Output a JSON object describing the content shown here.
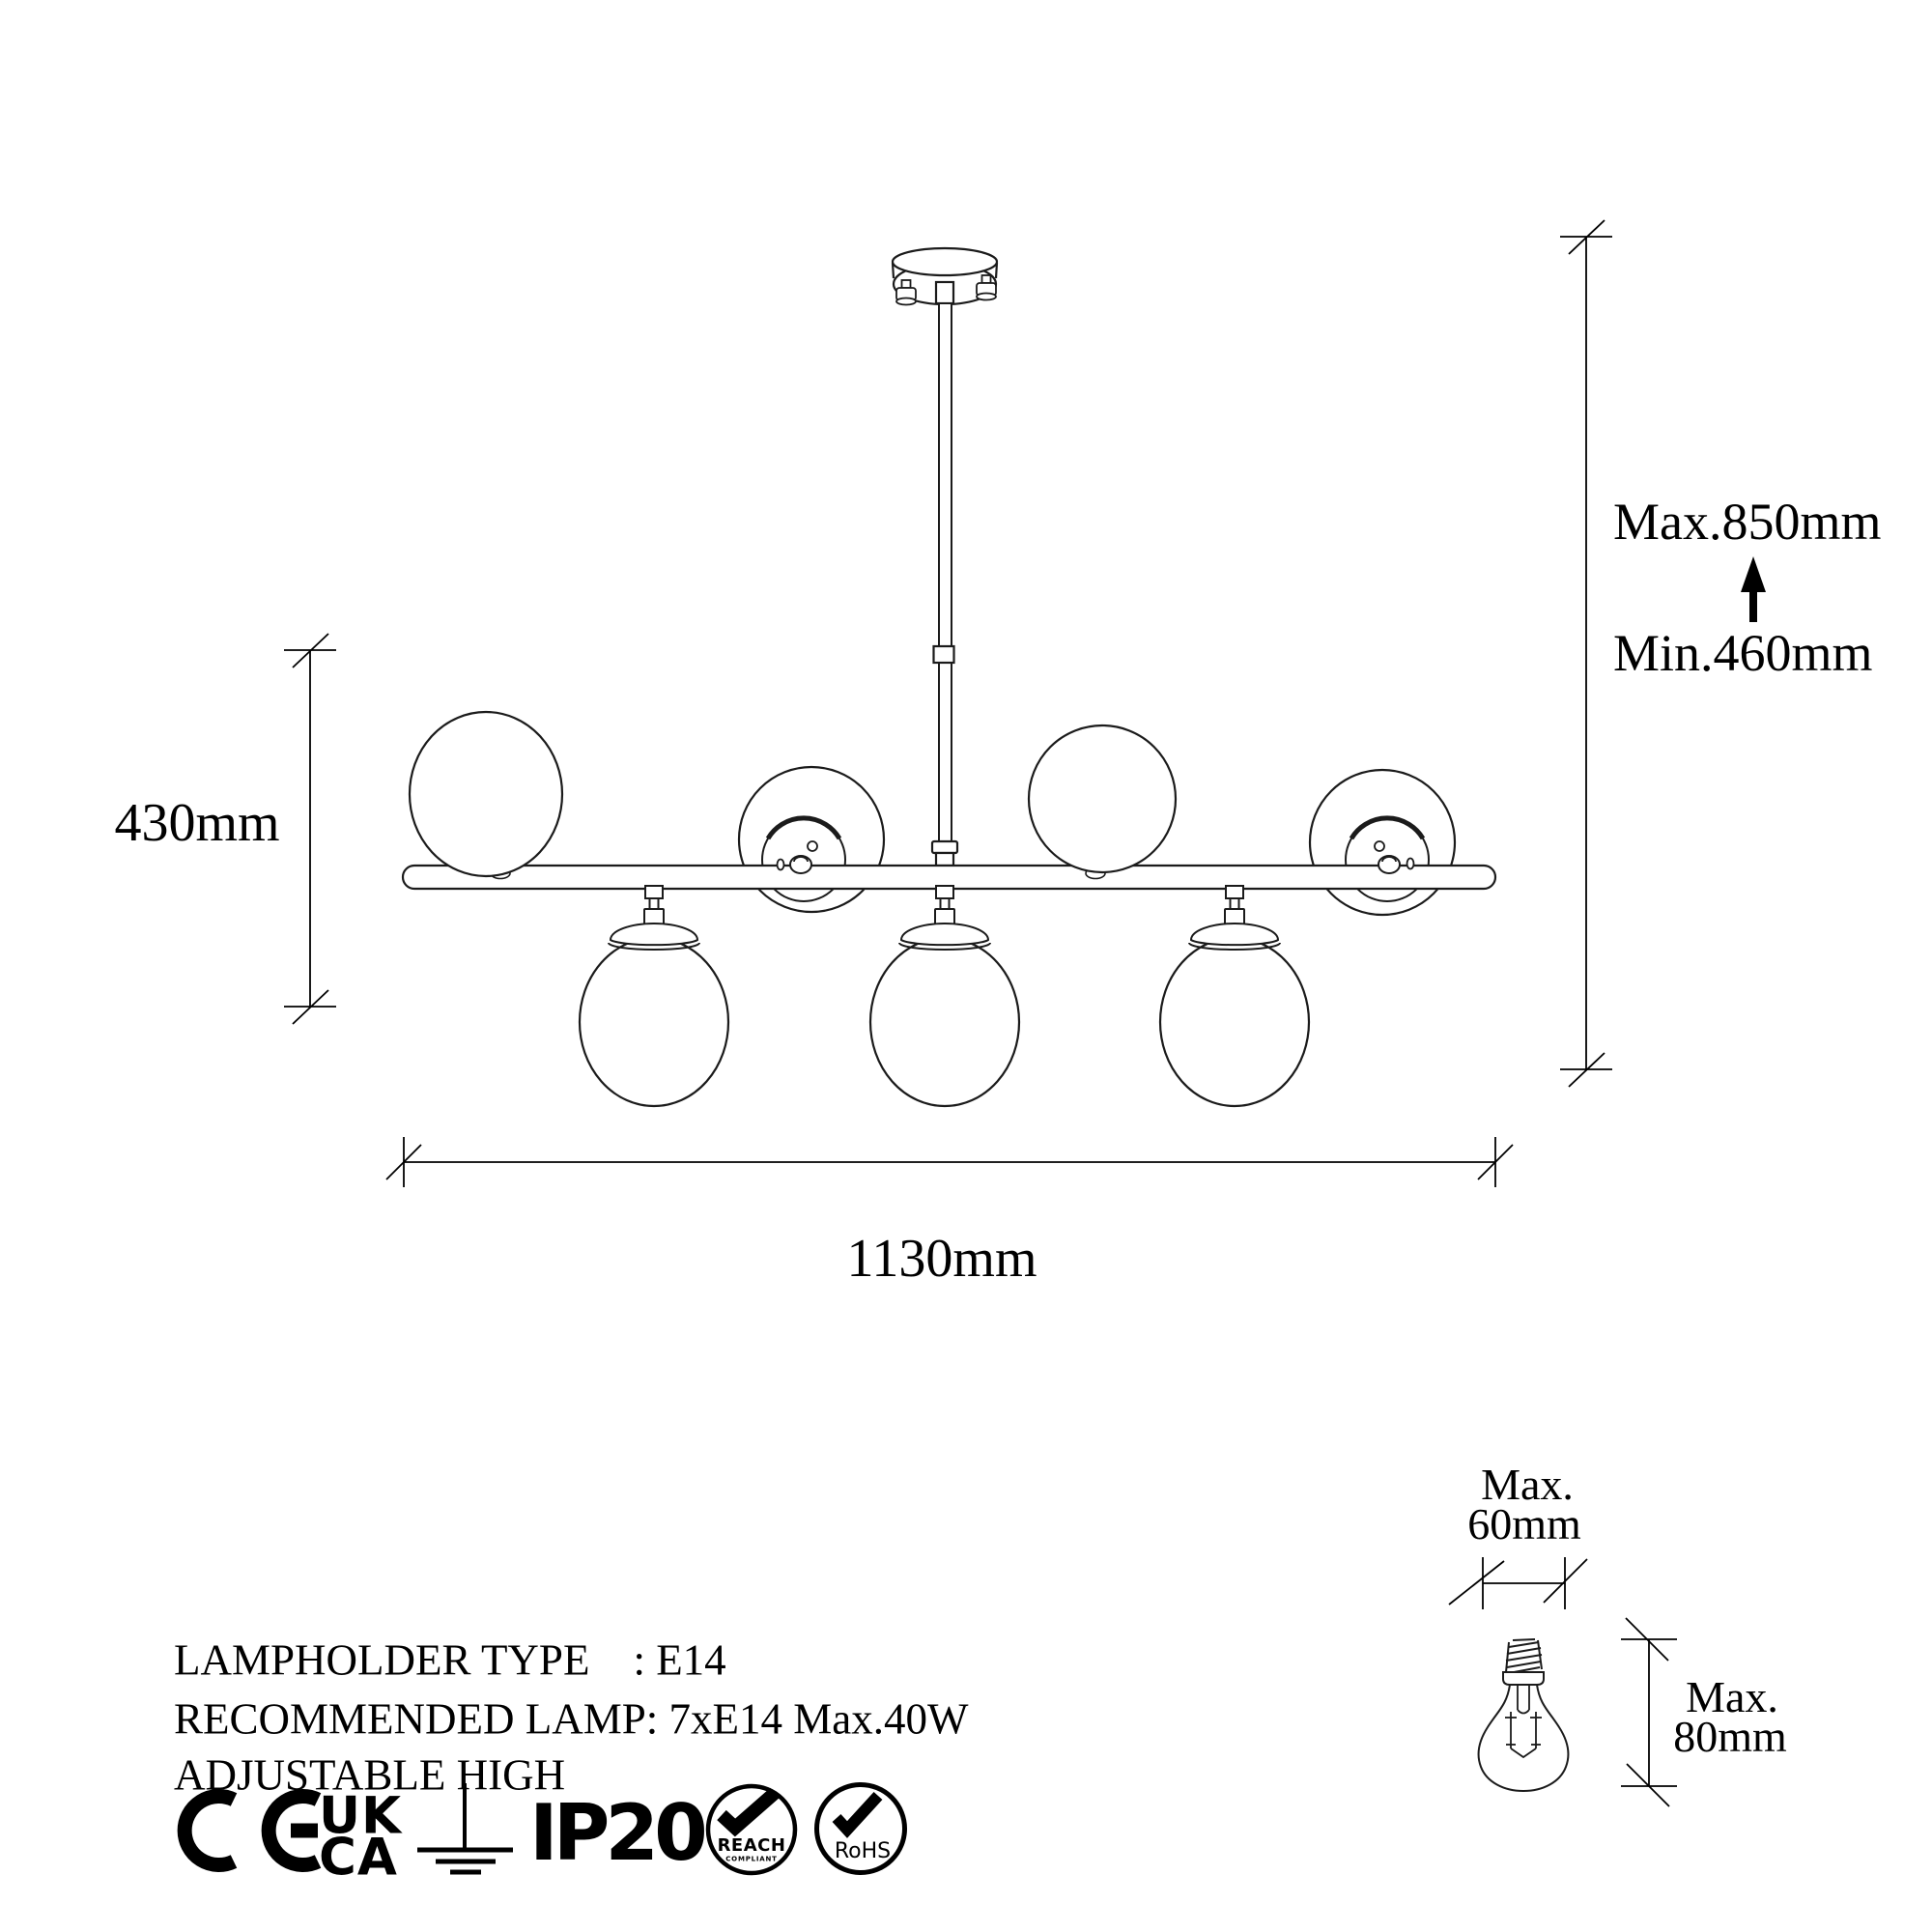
{
  "colors": {
    "background": "#ffffff",
    "ink": "#000000"
  },
  "dimension_labels": {
    "fixture_height": "430mm",
    "max_height": "Max.850mm",
    "min_height": "Min.460mm",
    "fixture_width": "1130mm",
    "bulb_width_prefix": "Max.",
    "bulb_width": "60mm",
    "bulb_height_prefix": "Max.",
    "bulb_height": "80mm"
  },
  "specifications": {
    "lampholder_type": "LAMPHOLDER TYPE    : E14",
    "recommended_lamp": "RECOMMENDED LAMP: 7xE14 Max.40W",
    "adjustable": "ADJUSTABLE HIGH"
  },
  "certifications": {
    "ukca_top": "UK",
    "ukca_bottom": "CA",
    "ip_rating": "IP20",
    "reach": "REACH",
    "reach_sub": "COMPLIANT",
    "rohs": "RoHS"
  }
}
